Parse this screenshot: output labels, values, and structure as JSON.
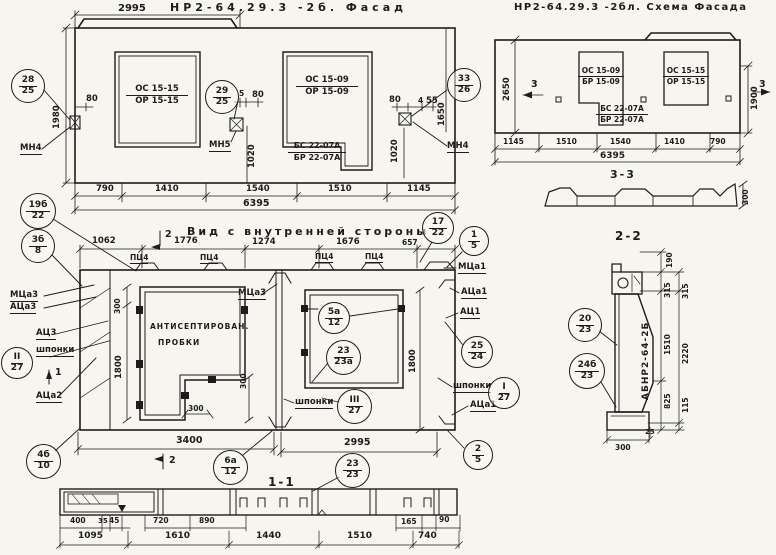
{
  "palette": {
    "paper": "#f7f5ef",
    "ink": "#1d1c1a"
  },
  "titles": {
    "facade": "НР2-64.29.3 -2б. Фасад",
    "schema": "НР2-64.29.3 -2бл. Схема Фасада",
    "interior": "Вид с внутренней стороны",
    "s11": "1-1",
    "s22": "2-2",
    "s33": "3-3"
  },
  "facade": {
    "dim_top": "2995",
    "dim_total": "6395",
    "dims_bottom": [
      "790",
      "1410",
      "1540",
      "1510",
      "1145"
    ],
    "dim_h_left": "1980",
    "dim_h_right": "1650",
    "dim_v_mid": "1020",
    "dim_v_right": "1020",
    "off_left": "80",
    "off_mid_a": "5",
    "off_mid_b": "80",
    "off_right_a": "80",
    "off_right_b": "4",
    "off_right_c": "55",
    "w1_top": "ОС 15-15",
    "w1_bot": "ОР 15-15",
    "w2_top": "ОС 15-09",
    "w2_bot": "ОР 15-09",
    "blk_top": "БС 22-07А",
    "blk_bot": "БР 22-07А",
    "anchor_left": "МН4",
    "anchor_mid": "МН5",
    "anchor_right": "МН4",
    "co1t": "28",
    "co1b": "25",
    "co2t": "29",
    "co2b": "25",
    "co3t": "33",
    "co3b": "26"
  },
  "schema": {
    "dim_total": "6395",
    "dims_bottom": [
      "1145",
      "1510",
      "1540",
      "1410",
      "790"
    ],
    "dim_h_left": "2650",
    "dim_h_right": "1900",
    "marker_left": "3",
    "marker_right": "3",
    "w1_top": "ОС 15-09",
    "w1_bot": "БР 15-09",
    "w2_top": "ОС 15-15",
    "w2_bot": "ОР 15-15",
    "blk_top": "БС 22-07А",
    "blk_bot": "БР 22-07А",
    "profile_h": "300"
  },
  "interior": {
    "dims_top": [
      "1062",
      "1776",
      "1274",
      "1676",
      "657"
    ],
    "plates": [
      "ПЦ4",
      "ПЦ4",
      "ПЦ4",
      "ПЦ4"
    ],
    "marker_1": "1",
    "marker_2_top": "2",
    "marker_2_bottom": "2",
    "lbl_mtsa3": "МЦа3",
    "lbl_atsa3": "АЦа3",
    "lbl_ats3": "АЦ3",
    "lbl_shponki_left": "шпонки",
    "lbl_atsa2": "АЦа2",
    "lbl_mtsa3_mid": "МЦа3",
    "lbl_mtsa1": "МЦа1",
    "lbl_atsa1": "АЦа1",
    "lbl_ats1": "АЦ1",
    "lbl_shponki_right": "шпонки",
    "lbl_atsa1_b": "АЦа1",
    "lbl_shponki_mid": "шпонки",
    "plugs_line1": "АНТИСЕПТИРОВАН.",
    "plugs_line2": "ПРОБКИ",
    "dim_300_top": "300",
    "dim_300_notch": "300",
    "dim_300_bottom": "300",
    "dim_w1_h": "1800",
    "dim_w2_h": "1800",
    "dim_seg_left": "3400",
    "dim_seg_right": "2995",
    "c19b_t": "19б",
    "c19b_b": "22",
    "c3b_t": "3б",
    "c3b_b": "8",
    "c17_t": "17",
    "c17_b": "22",
    "c1_t": "1",
    "c1_b": "5",
    "cII_t": "II",
    "cII_b": "27",
    "cI_t": "I",
    "cI_b": "27",
    "cIII_t": "III",
    "cIII_b": "27",
    "c5a_t": "5а",
    "c5a_b": "12",
    "c23a_t": "23",
    "c23a_b": "23а",
    "c25_t": "25",
    "c25_b": "24",
    "c2_t": "2",
    "c2_b": "5",
    "c4b_t": "4б",
    "c4b_b": "10",
    "c6a_t": "6а",
    "c6a_b": "12",
    "c23_t": "23",
    "c23_b": "23"
  },
  "s11": {
    "dims_top": [
      "400",
      "35",
      "45",
      "720",
      "890",
      "165",
      "90"
    ],
    "dims_bottom": [
      "1095",
      "1610",
      "1440",
      "1510",
      "740"
    ]
  },
  "s22": {
    "body": "АБНР2-64-2Б",
    "d190": "190",
    "d315a": "315",
    "d315b": "315",
    "d1510": "1510",
    "d2220": "2220",
    "d825": "825",
    "d115": "115",
    "d25": "25",
    "d300": "300",
    "co20t": "20",
    "co20b": "23",
    "co24t": "24б",
    "co24b": "23"
  }
}
